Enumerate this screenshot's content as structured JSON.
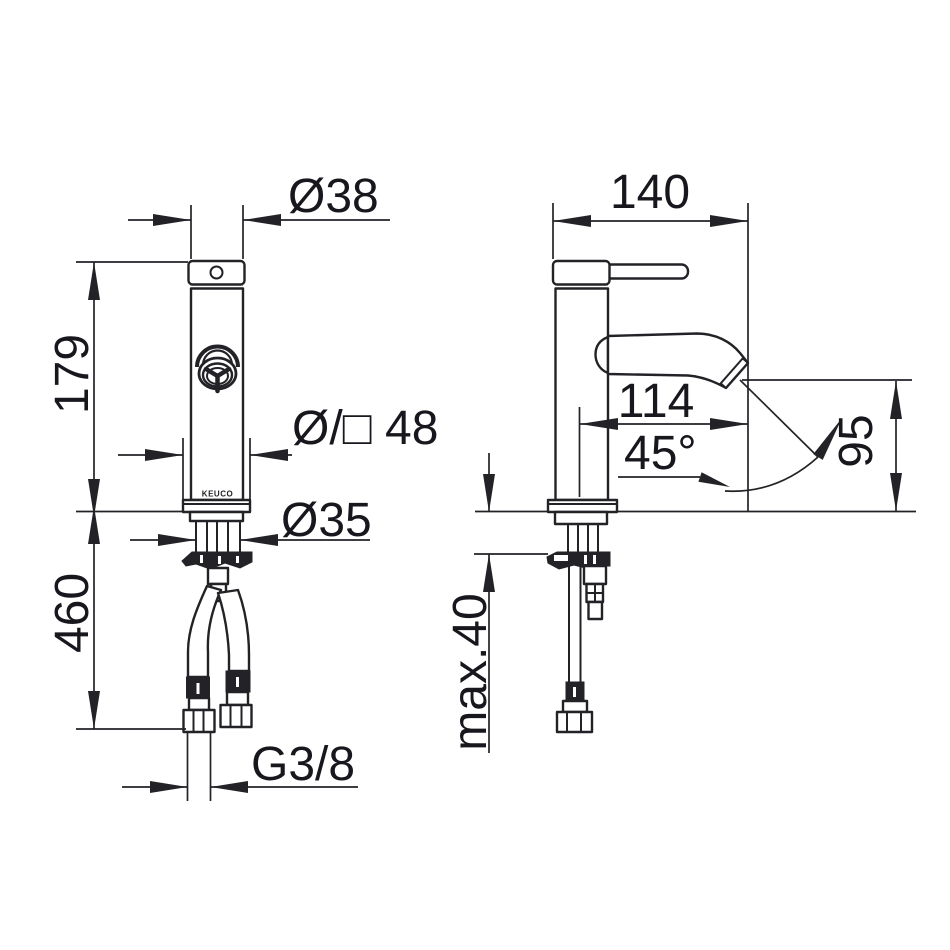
{
  "meta": {
    "title": "Single-lever basin mixer – installation dimension drawing",
    "views": {
      "front_name": "front view",
      "side_name": "side view"
    }
  },
  "theme": {
    "background": "#ffffff",
    "line": "#232327",
    "text": "#17171d"
  },
  "front_view": {
    "logo": "KEUCO",
    "dim_top_diameter": "Ø38",
    "dim_body_height": "179",
    "dim_base": "Ø/□ 48",
    "dim_shank_diameter": "Ø35",
    "dim_hose_length": "460",
    "dim_thread": "G3/8"
  },
  "side_view": {
    "dim_depth": "140",
    "dim_spout_reach": "114",
    "dim_spout_angle": "45°",
    "dim_spout_height": "95",
    "dim_mounting_max": "max.40"
  }
}
